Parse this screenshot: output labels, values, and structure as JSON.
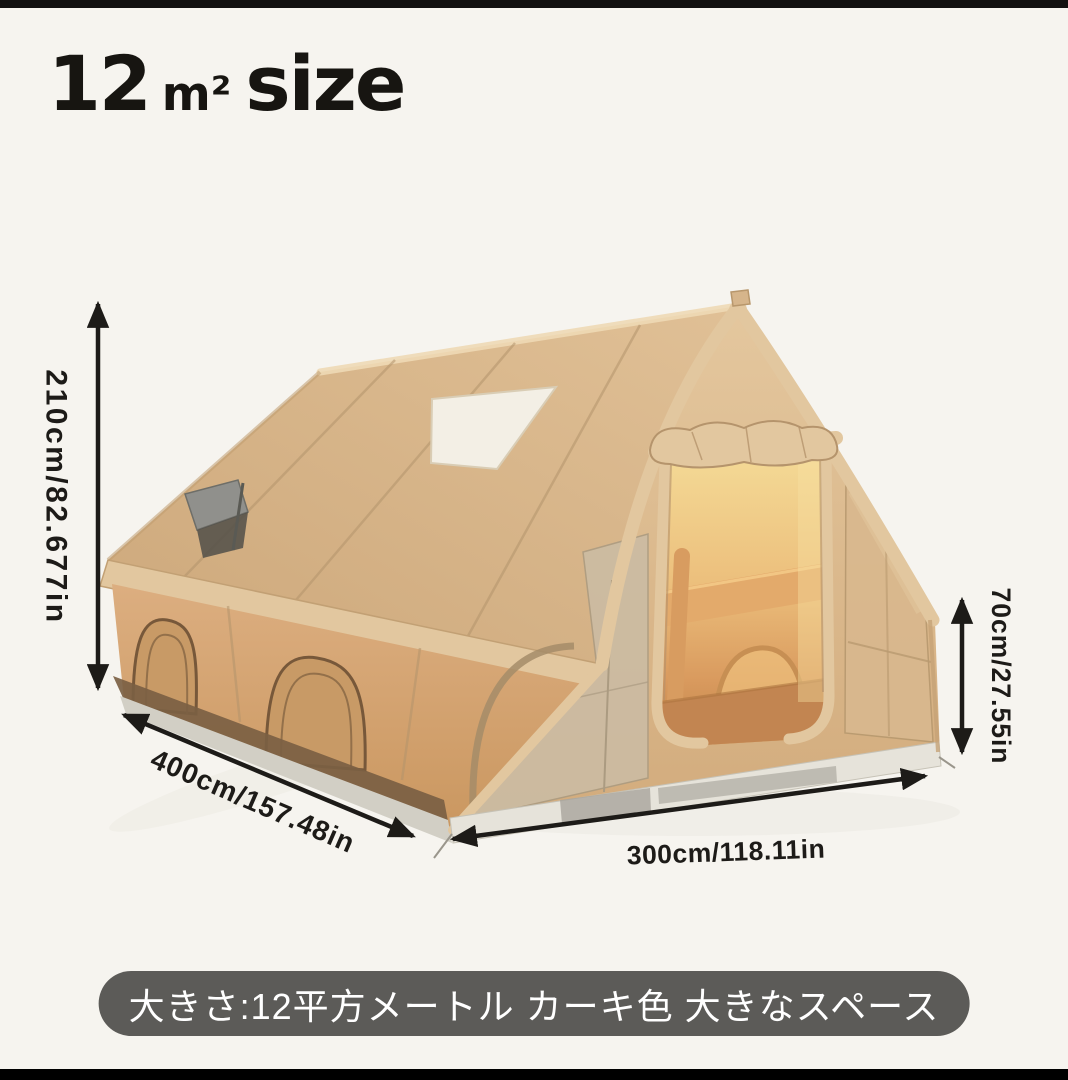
{
  "window": {
    "background": "#f6f4ef",
    "top_bar": "#121110",
    "bottom_bar": "#000000"
  },
  "title": {
    "number": "12",
    "unit": "m²",
    "word": "size",
    "color": "#171511"
  },
  "dimension_labels": {
    "tent_height": "210cm/82.677in",
    "tent_depth": "400cm/157.48in",
    "tent_width": "300cm/118.11in",
    "wall_height": "70cm/27.55in"
  },
  "caption": {
    "text": "大きさ:12平方メートル カーキ色 大きなスペース",
    "background": "#5c5b58",
    "text_color": "#ffffff"
  },
  "illustration": {
    "name": "inflatable-cabin-tent",
    "arrow_color": "#1d1b18",
    "palette": {
      "canvas": "#d6b58b",
      "canvas_light": "#e2c79f",
      "side_wall": "#d5a676",
      "window_frame": "#77583a",
      "dark_band": "#7b5f43",
      "interior_beam": "#e3aa6b",
      "interior_floor": "#c28551",
      "mesh_panel": "#cbbca4",
      "right_panel": "#d9b88e",
      "skirt": "#e6e3da",
      "skirt_dark": "#a4a098",
      "skirt_side": "#d2cfc5",
      "skylight": "#f3efe5",
      "vent": "#90908c",
      "shadow": "#e9e6de"
    }
  }
}
